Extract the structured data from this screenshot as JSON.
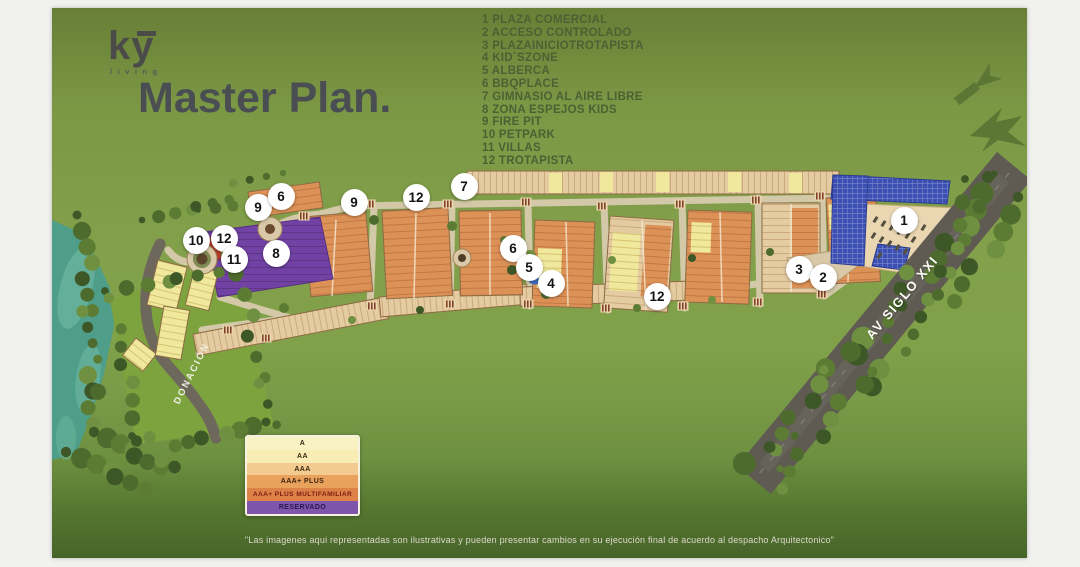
{
  "page": {
    "title": "Master Plan.",
    "disclaimer": "\"Las imagenes aqui representadas son ilustrativas y pueden presentar cambios en su ejecución final de acuerdo al despacho Arquitectonico\""
  },
  "logo": {
    "brand": "ky",
    "tagline": "living"
  },
  "amenities": {
    "items": [
      {
        "num": "1",
        "label": "PLAZA COMERCIAL"
      },
      {
        "num": "2",
        "label": "ACCESO CONTROLADO"
      },
      {
        "num": "3",
        "label": "PLAZAINICIOTROTAPISTA"
      },
      {
        "num": "4",
        "label": "KID´SZONE"
      },
      {
        "num": "5",
        "label": "ALBERCA"
      },
      {
        "num": "6",
        "label": "BBQPLACE"
      },
      {
        "num": "7",
        "label": "GIMNASIO AL AIRE LIBRE"
      },
      {
        "num": "8",
        "label": "ZONA ESPEJOS KIDS"
      },
      {
        "num": "9",
        "label": "FIRE PIT"
      },
      {
        "num": "10",
        "label": "PETPARK"
      },
      {
        "num": "11",
        "label": "VILLAS"
      },
      {
        "num": "12",
        "label": "TROTAPISTA"
      }
    ]
  },
  "map": {
    "labels": {
      "avenue": "AV SIGLO XXI",
      "donation": "DONACIÓN"
    },
    "markers": [
      {
        "num": "10",
        "x": 144,
        "y": 232
      },
      {
        "num": "12",
        "x": 172,
        "y": 230
      },
      {
        "num": "11",
        "x": 182,
        "y": 251
      },
      {
        "num": "9",
        "x": 206,
        "y": 199
      },
      {
        "num": "6",
        "x": 229,
        "y": 188
      },
      {
        "num": "8",
        "x": 224,
        "y": 245
      },
      {
        "num": "9",
        "x": 302,
        "y": 194
      },
      {
        "num": "12",
        "x": 364,
        "y": 189
      },
      {
        "num": "7",
        "x": 412,
        "y": 178
      },
      {
        "num": "6",
        "x": 461,
        "y": 240
      },
      {
        "num": "5",
        "x": 477,
        "y": 259
      },
      {
        "num": "4",
        "x": 499,
        "y": 275
      },
      {
        "num": "12",
        "x": 605,
        "y": 288
      },
      {
        "num": "3",
        "x": 747,
        "y": 261
      },
      {
        "num": "2",
        "x": 771,
        "y": 269
      },
      {
        "num": "1",
        "x": 852,
        "y": 212
      }
    ]
  },
  "housing_legend": {
    "rows": [
      {
        "label": "A",
        "bg": "#f9f2c3",
        "fg": "#3a2a12"
      },
      {
        "label": "AA",
        "bg": "#f8eeb5",
        "fg": "#3a2a12"
      },
      {
        "label": "AAA",
        "bg": "#f3ca90",
        "fg": "#3a2a12"
      },
      {
        "label": "AAA+ PLUS",
        "bg": "#e9a25c",
        "fg": "#3a2413"
      },
      {
        "label": "AAA+ PLUS MULTIFAMILIAR",
        "bg": "#dd8147",
        "fg": "#7e1b15"
      },
      {
        "label": "RESERVADO",
        "bg": "#7d56ac",
        "fg": "#2c1850"
      }
    ]
  },
  "colors": {
    "background_green": "#7e9c47",
    "title_text": "#4a4e53",
    "legend_text": "#4b6134",
    "marker_bg": "#ffffff",
    "water": "#4f9e8a",
    "avenue_road": "#5f5b52",
    "plaza_roof": "#3c50b4",
    "reserved_purple": "#7142a4"
  }
}
